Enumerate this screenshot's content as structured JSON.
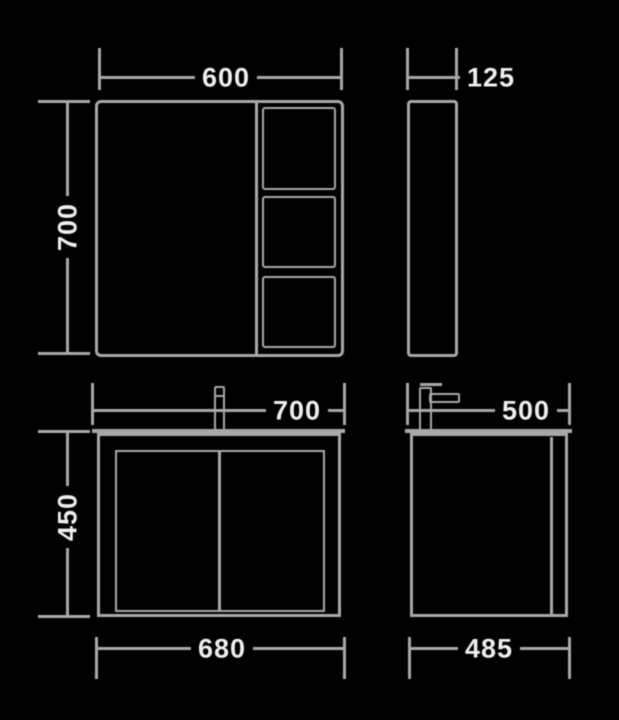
{
  "colors": {
    "bg": "#000000",
    "line": "#a8a8a8",
    "text": "#eeeeee"
  },
  "dims": {
    "mirror_width": "600",
    "mirror_depth": "125",
    "mirror_height": "700",
    "vanity_top_width": "700",
    "vanity_top_depth": "500",
    "vanity_height": "450",
    "vanity_base_width": "680",
    "vanity_base_depth": "485"
  }
}
